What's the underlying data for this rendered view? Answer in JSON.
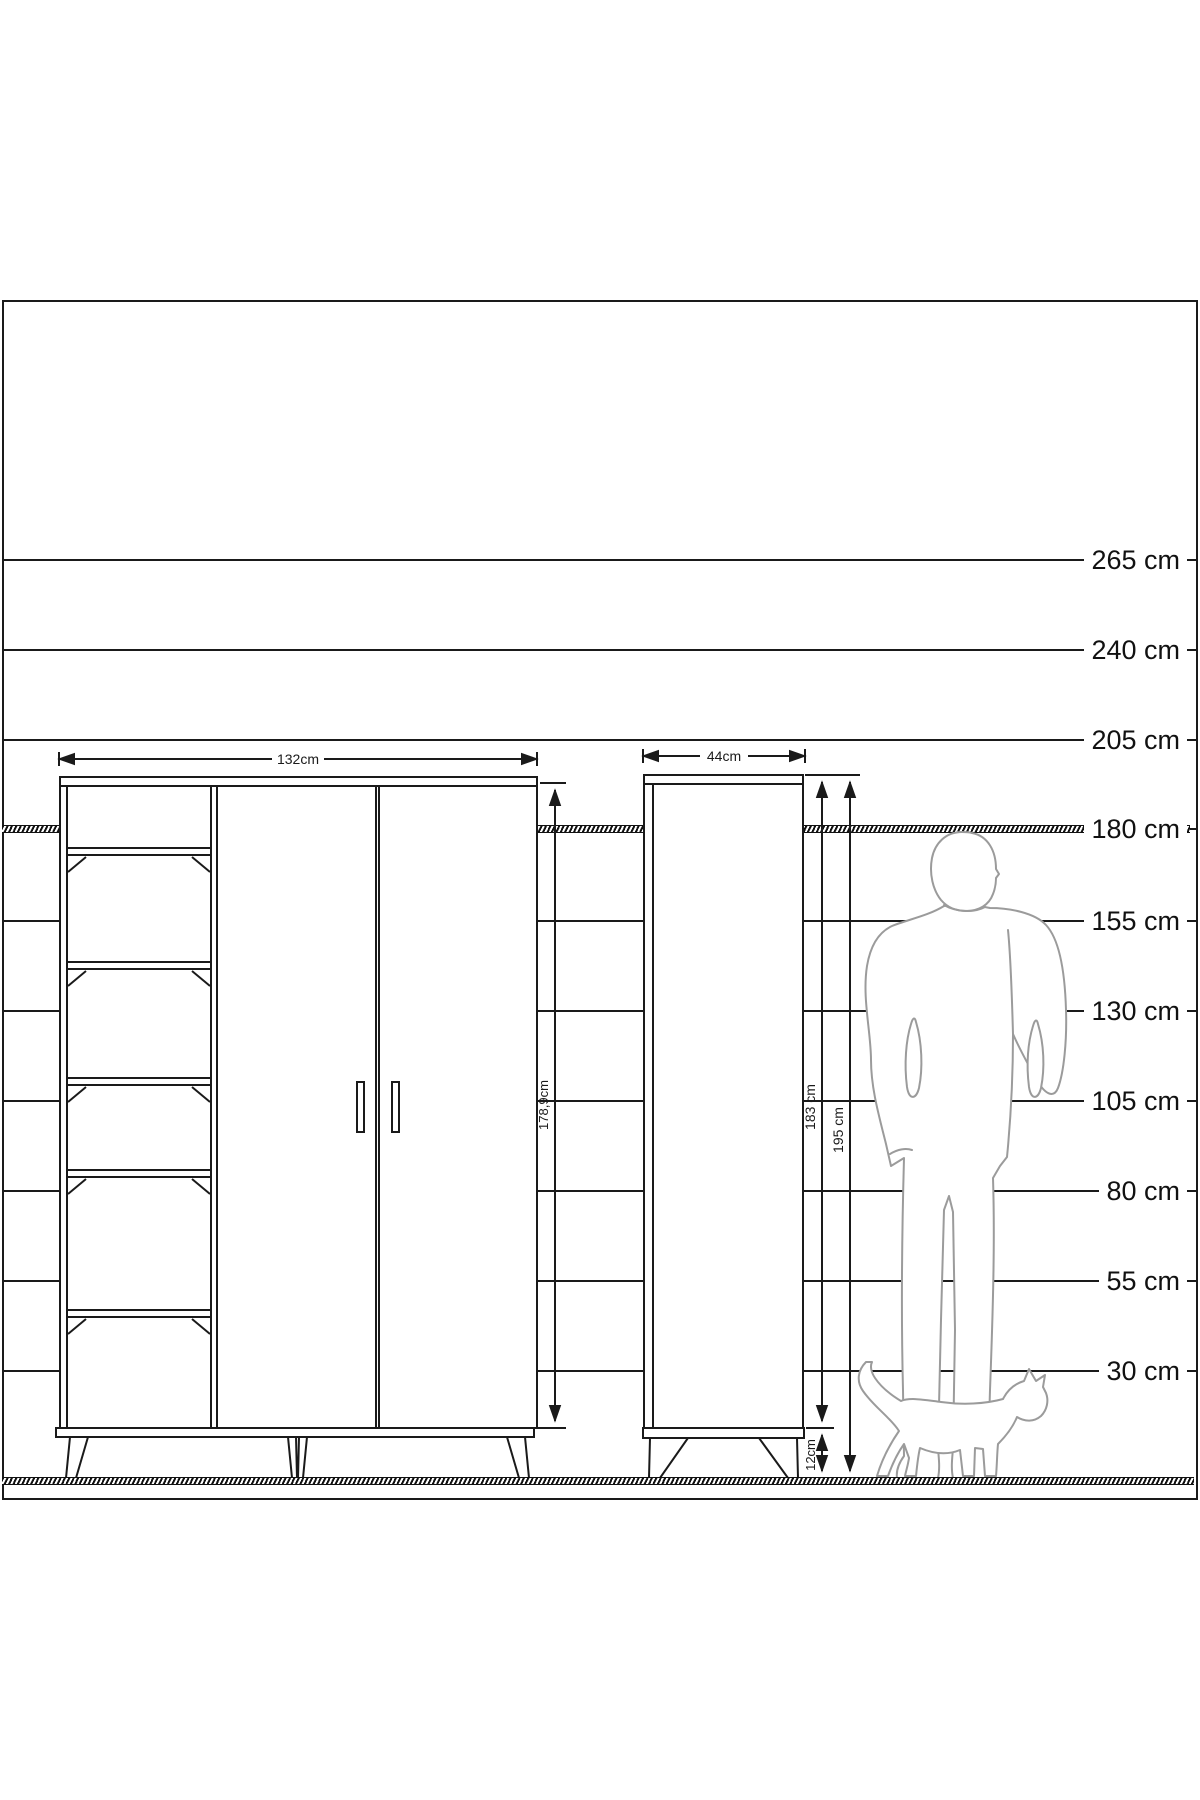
{
  "scale": {
    "labels": [
      "265 cm",
      "240 cm",
      "205 cm",
      "180 cm",
      "155 cm",
      "130 cm",
      "105 cm",
      "80 cm",
      "55 cm",
      "30 cm"
    ]
  },
  "front_cabinet": {
    "width_label": "132cm",
    "height_label": "178,9cm"
  },
  "side_cabinet": {
    "width_label": "44cm",
    "body_height_label": "183 cm",
    "total_height_label": "195 cm",
    "leg_height_label": "12cm"
  },
  "figures": {
    "man": "man-silhouette",
    "cat": "cat-silhouette"
  },
  "colors": {
    "ink": "#1a1a1a",
    "silhouette": "#9b9b9b",
    "paper": "#ffffff"
  }
}
